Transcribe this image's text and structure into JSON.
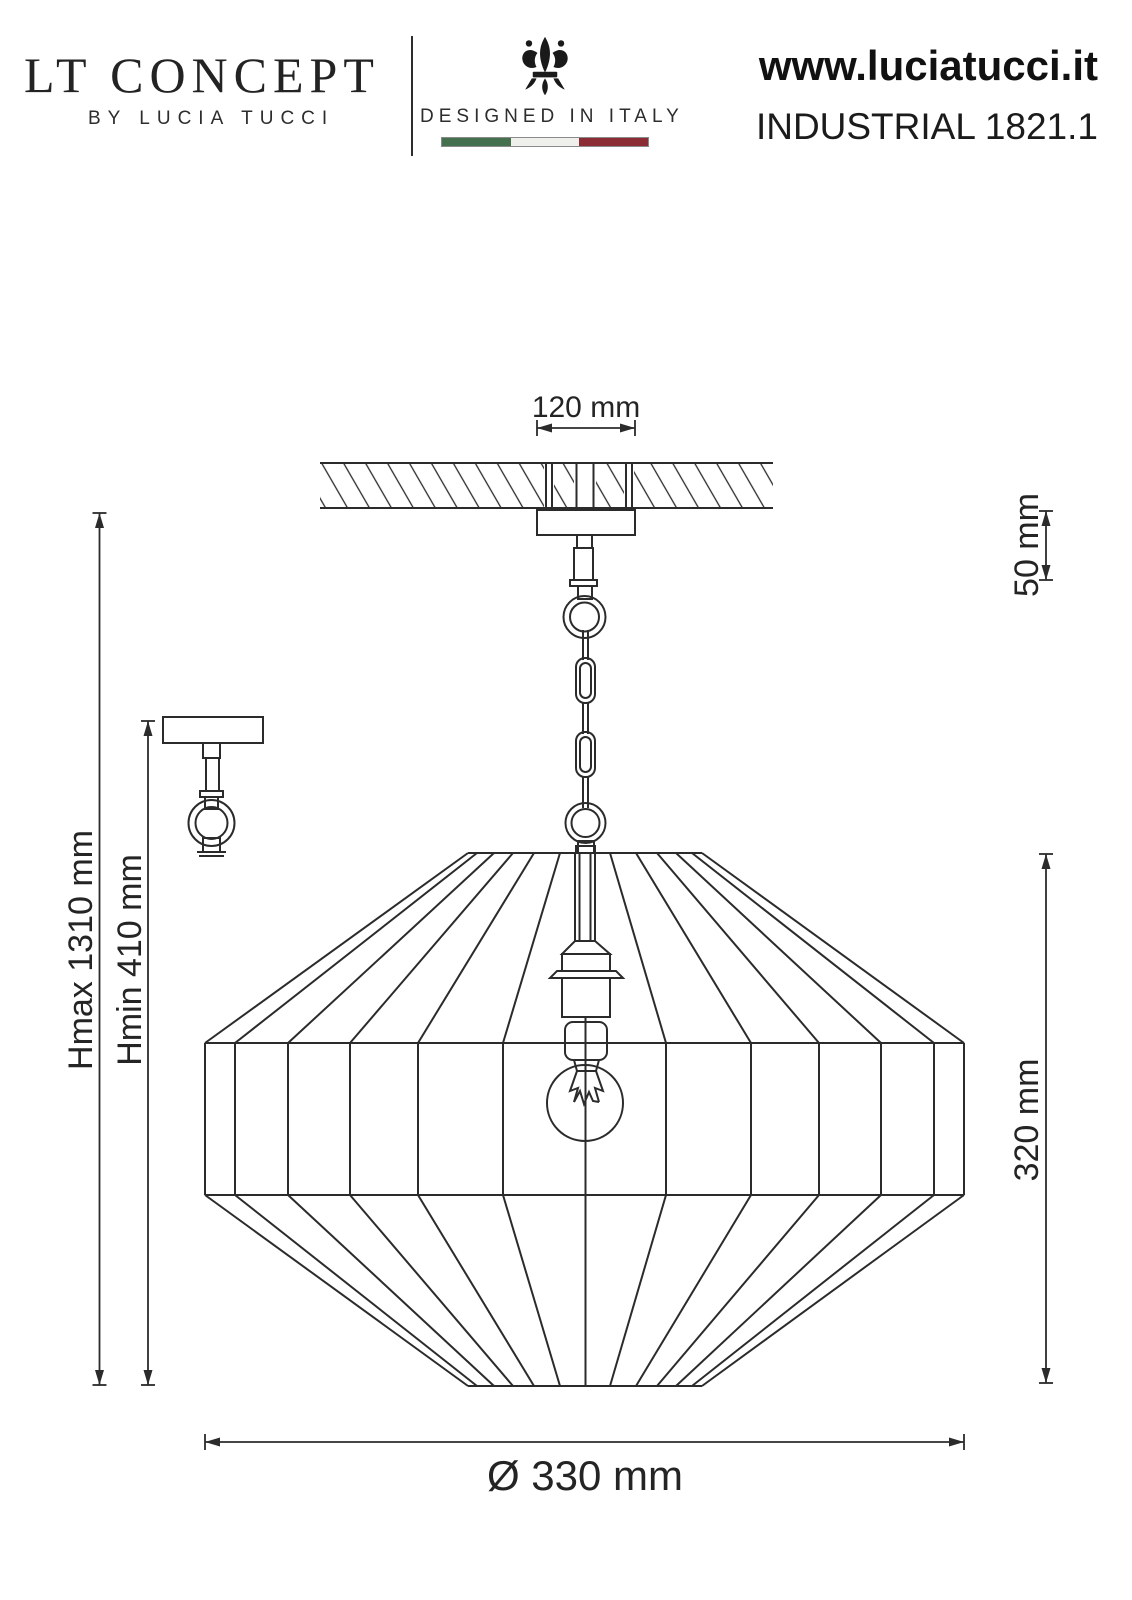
{
  "header": {
    "brand_title": "LT CONCEPT",
    "brand_subtitle": "BY LUCIA TUCCI",
    "designed_in": "DESIGNED IN ITALY",
    "website": "www.luciatucci.it",
    "product_code": "INDUSTRIAL 1821.1"
  },
  "drawing": {
    "dim_canopy_width": "120 mm",
    "dim_canopy_height": "50 mm",
    "dim_height_max": "Hmax 1310 mm",
    "dim_height_min": "Hmin 410 mm",
    "dim_shade_height": "320 mm",
    "dim_shade_diameter": "Ø 330 mm"
  },
  "colors": {
    "line": "#2b2b2b",
    "text": "#222222",
    "flag_green": "#44704e",
    "flag_white": "#efefec",
    "flag_red": "#8c2d35"
  }
}
